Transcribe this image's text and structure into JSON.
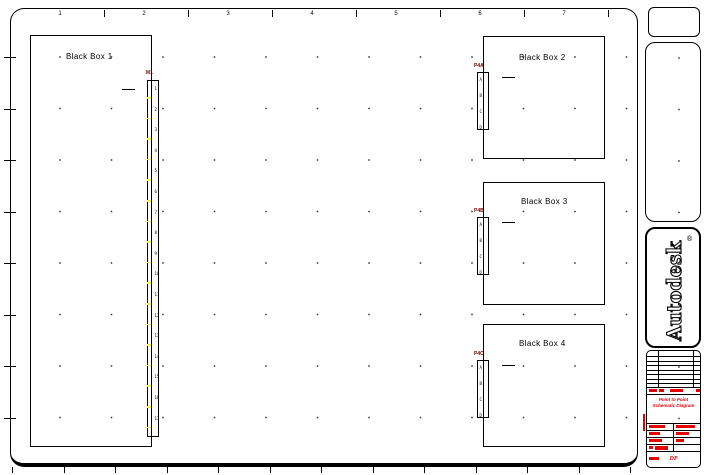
{
  "sheet": {
    "ruler_numbers": [
      "1",
      "2",
      "3",
      "4",
      "5",
      "6",
      "7"
    ]
  },
  "boxes": [
    {
      "label": "Black Box 1",
      "connector": {
        "label": "M1",
        "pins": [
          "1",
          "2",
          "3",
          "4",
          "5",
          "6",
          "7",
          "8",
          "9",
          "10",
          "11",
          "12",
          "13",
          "14",
          "15",
          "16",
          "17"
        ]
      }
    },
    {
      "label": "Black Box 2",
      "connector": {
        "label": "P4A",
        "pins": [
          "A",
          "B",
          "C",
          "D"
        ]
      }
    },
    {
      "label": "Black Box 3",
      "connector": {
        "label": "P4B",
        "pins": [
          "A",
          "B",
          "C",
          "D"
        ]
      }
    },
    {
      "label": "Black Box 4",
      "connector": {
        "label": "P4C",
        "pins": [
          "A",
          "B",
          "C",
          "D"
        ]
      }
    }
  ],
  "logo": {
    "text": "Autodesk",
    "registered": "®"
  },
  "title_block": {
    "description_line1": "Point to Point",
    "description_line2": "Schematic Diagram",
    "sheet_code": "DP"
  },
  "colors": {
    "line": "#000000",
    "connector_label": "#7a0000",
    "pin_tick_yellow": "#ffff00",
    "title_block_red": "#e60000"
  }
}
